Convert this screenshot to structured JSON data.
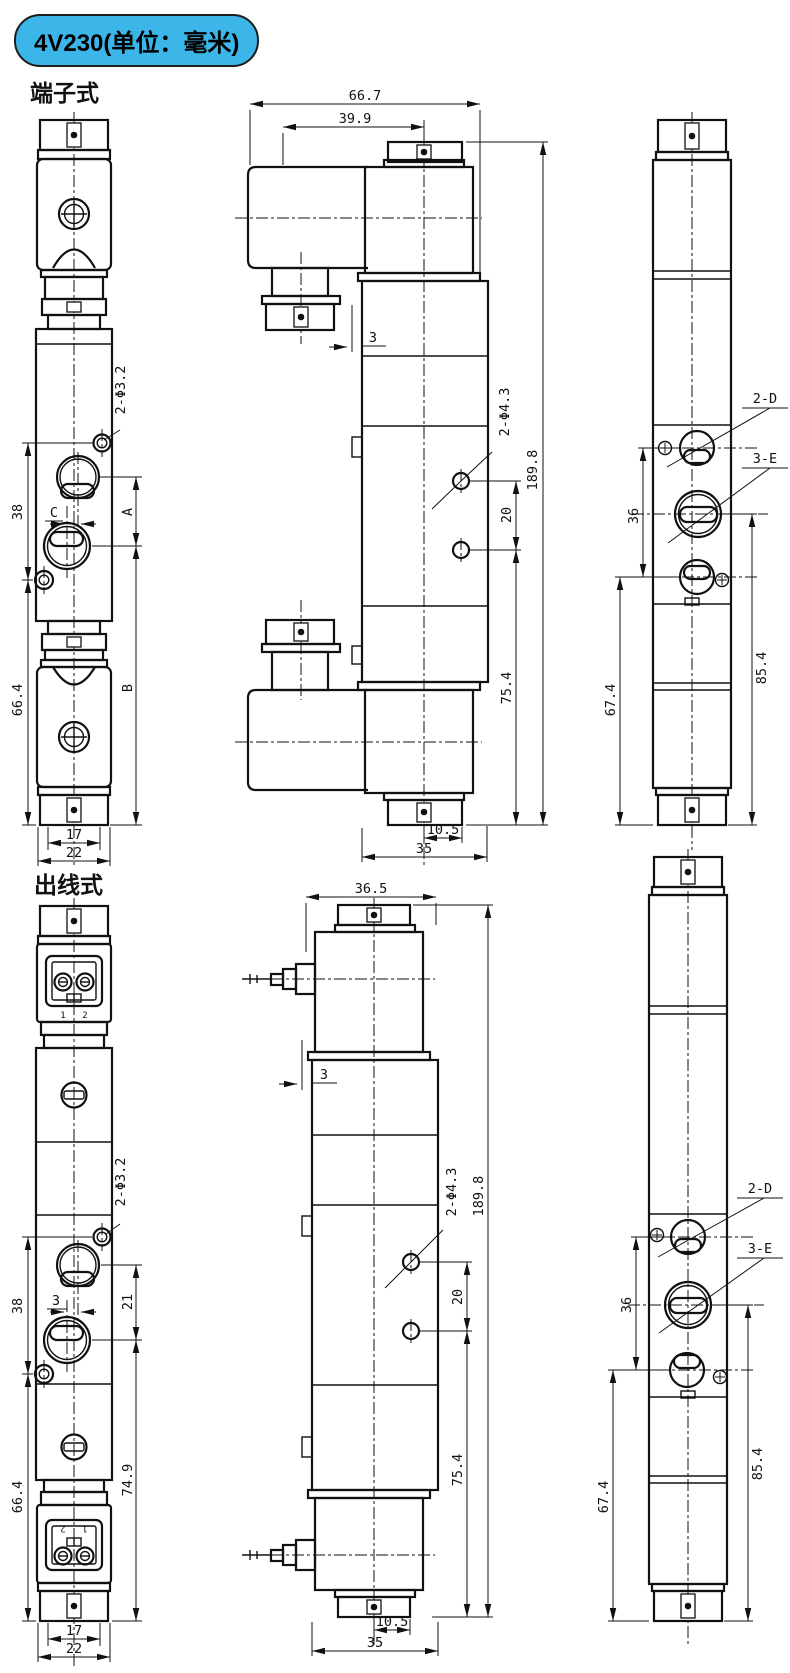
{
  "badge": {
    "label": "4V230(单位：毫米)",
    "bg_color": "#3cb5e8"
  },
  "section1": {
    "label": "端子式"
  },
  "section2": {
    "label": "出线式"
  },
  "s1": {
    "front": {
      "hole": "2-Φ3.2",
      "d38": "38",
      "dC": "C",
      "dA": "A",
      "dB": "B",
      "d664": "66.4",
      "d17": "17",
      "d22": "22"
    },
    "side": {
      "d667": "66.7",
      "d399": "39.9",
      "d3": "3",
      "hole": "2-Φ4.3",
      "d20": "20",
      "d1898": "189.8",
      "d754": "75.4",
      "d105": "10.5",
      "d35": "35"
    },
    "bottom": {
      "p2d": "2-D",
      "p3e": "3-E",
      "d36": "36",
      "d674": "67.4",
      "d854": "85.4"
    }
  },
  "s2": {
    "front": {
      "hole": "2-Φ3.2",
      "d38": "38",
      "d3": "3",
      "d21": "21",
      "d664": "66.4",
      "d749": "74.9",
      "d17": "17",
      "d22": "22",
      "t1": "1",
      "t2": "2"
    },
    "side": {
      "d365": "36.5",
      "d3": "3",
      "hole": "2-Φ4.3",
      "d20": "20",
      "d1898": "189.8",
      "d754": "75.4",
      "d105": "10.5",
      "d35": "35"
    },
    "bottom": {
      "p2d": "2-D",
      "p3e": "3-E",
      "d36": "36",
      "d674": "67.4",
      "d854": "85.4"
    }
  }
}
